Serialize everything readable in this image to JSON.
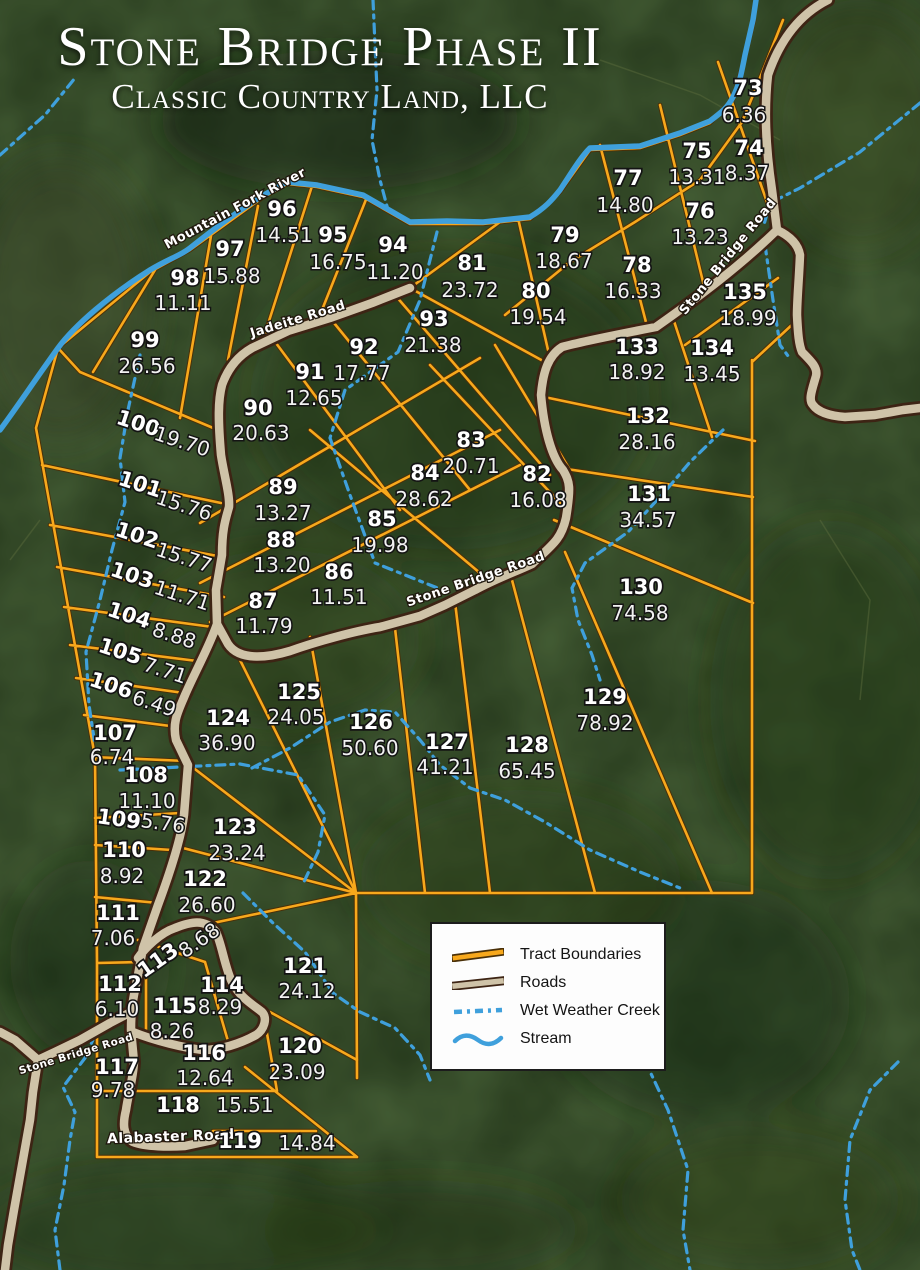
{
  "title": {
    "line1": "Stone Bridge Phase II",
    "line2": "Classic Country Land, LLC"
  },
  "legend": {
    "items": [
      {
        "key": "tract",
        "label": "Tract Boundaries"
      },
      {
        "key": "road",
        "label": "Roads"
      },
      {
        "key": "creek",
        "label": "Wet Weather Creek"
      },
      {
        "key": "stream",
        "label": "Stream"
      }
    ]
  },
  "colors": {
    "tract_boundary": "#F7A81C",
    "tract_boundary_edge": "#4a3008",
    "road_fill": "#CFC3A8",
    "road_edge": "#3d2414",
    "water": "#3FA0DC",
    "label_text": "#ffffff",
    "background_green": "#26391d"
  },
  "road_labels": [
    {
      "name": "Mountain Fork River",
      "x": 237,
      "y": 212,
      "rot": -28,
      "size": 13
    },
    {
      "name": "Jadeite Road",
      "x": 299,
      "y": 323,
      "rot": -17,
      "size": 13
    },
    {
      "name": "Stone Bridge Road",
      "x": 731,
      "y": 259,
      "rot": -51,
      "size": 13
    },
    {
      "name": "Stone Bridge Road",
      "x": 477,
      "y": 583,
      "rot": -19,
      "size": 13
    },
    {
      "name": "Stone Bridge Road",
      "x": 77,
      "y": 1057,
      "rot": -17,
      "size": 10.5
    },
    {
      "name": "Alabaster Road",
      "x": 171,
      "y": 1141,
      "rot": -2,
      "size": 14
    }
  ],
  "tracts": [
    {
      "num": "73",
      "acres": "6.36",
      "x": 748,
      "y": 95,
      "ax": 744,
      "ay": 122,
      "rot": 0
    },
    {
      "num": "74",
      "acres": "8.37",
      "x": 749,
      "y": 155,
      "ax": 747,
      "ay": 180,
      "rot": 0
    },
    {
      "num": "75",
      "acres": "13.31",
      "x": 697,
      "y": 158,
      "ax": 697,
      "ay": 184,
      "rot": 0
    },
    {
      "num": "76",
      "acres": "13.23",
      "x": 700,
      "y": 218,
      "ax": 700,
      "ay": 244,
      "rot": 0
    },
    {
      "num": "77",
      "acres": "14.80",
      "x": 628,
      "y": 185,
      "ax": 625,
      "ay": 212,
      "rot": 0
    },
    {
      "num": "78",
      "acres": "16.33",
      "x": 637,
      "y": 272,
      "ax": 633,
      "ay": 298,
      "rot": 0
    },
    {
      "num": "79",
      "acres": "18.67",
      "x": 565,
      "y": 242,
      "ax": 564,
      "ay": 268,
      "rot": 0
    },
    {
      "num": "80",
      "acres": "19.54",
      "x": 536,
      "y": 298,
      "ax": 538,
      "ay": 324,
      "rot": 0
    },
    {
      "num": "81",
      "acres": "23.72",
      "x": 472,
      "y": 270,
      "ax": 470,
      "ay": 297,
      "rot": 0
    },
    {
      "num": "82",
      "acres": "16.08",
      "x": 537,
      "y": 481,
      "ax": 538,
      "ay": 507,
      "rot": 0
    },
    {
      "num": "83",
      "acres": "20.71",
      "x": 471,
      "y": 447,
      "ax": 471,
      "ay": 473,
      "rot": 0
    },
    {
      "num": "84",
      "acres": "28.62",
      "x": 425,
      "y": 480,
      "ax": 424,
      "ay": 506,
      "rot": 0
    },
    {
      "num": "85",
      "acres": "19.98",
      "x": 382,
      "y": 526,
      "ax": 380,
      "ay": 552,
      "rot": 0
    },
    {
      "num": "86",
      "acres": "11.51",
      "x": 339,
      "y": 579,
      "ax": 339,
      "ay": 604,
      "rot": 0
    },
    {
      "num": "87",
      "acres": "11.79",
      "x": 263,
      "y": 608,
      "ax": 264,
      "ay": 633,
      "rot": 0
    },
    {
      "num": "88",
      "acres": "13.20",
      "x": 281,
      "y": 547,
      "ax": 282,
      "ay": 572,
      "rot": 0
    },
    {
      "num": "89",
      "acres": "13.27",
      "x": 283,
      "y": 494,
      "ax": 283,
      "ay": 520,
      "rot": 0
    },
    {
      "num": "90",
      "acres": "20.63",
      "x": 258,
      "y": 415,
      "ax": 261,
      "ay": 440,
      "rot": 0
    },
    {
      "num": "91",
      "acres": "12.65",
      "x": 310,
      "y": 379,
      "ax": 314,
      "ay": 405,
      "rot": 0
    },
    {
      "num": "92",
      "acres": "17.77",
      "x": 364,
      "y": 354,
      "ax": 362,
      "ay": 380,
      "rot": 0
    },
    {
      "num": "93",
      "acres": "21.38",
      "x": 434,
      "y": 326,
      "ax": 433,
      "ay": 352,
      "rot": 0
    },
    {
      "num": "94",
      "acres": "11.20",
      "x": 393,
      "y": 252,
      "ax": 395,
      "ay": 279,
      "rot": 0
    },
    {
      "num": "95",
      "acres": "16.75",
      "x": 333,
      "y": 242,
      "ax": 338,
      "ay": 269,
      "rot": 0
    },
    {
      "num": "96",
      "acres": "14.51",
      "x": 282,
      "y": 216,
      "ax": 284,
      "ay": 242,
      "rot": 0
    },
    {
      "num": "97",
      "acres": "15.88",
      "x": 230,
      "y": 256,
      "ax": 232,
      "ay": 283,
      "rot": 0
    },
    {
      "num": "98",
      "acres": "11.11",
      "x": 185,
      "y": 285,
      "ax": 183,
      "ay": 310,
      "rot": 0
    },
    {
      "num": "99",
      "acres": "26.56",
      "x": 145,
      "y": 347,
      "ax": 147,
      "ay": 373,
      "rot": 0
    },
    {
      "num": "100",
      "acres": "19.70",
      "x": 136,
      "y": 430,
      "ax": 180,
      "ay": 448,
      "rot": 18
    },
    {
      "num": "101",
      "acres": "15.76",
      "x": 138,
      "y": 491,
      "ax": 182,
      "ay": 512,
      "rot": 18
    },
    {
      "num": "102",
      "acres": "15.77",
      "x": 135,
      "y": 542,
      "ax": 182,
      "ay": 564,
      "rot": 18
    },
    {
      "num": "103",
      "acres": "11.71",
      "x": 130,
      "y": 582,
      "ax": 180,
      "ay": 602,
      "rot": 18
    },
    {
      "num": "104",
      "acres": "8.88",
      "x": 127,
      "y": 622,
      "ax": 172,
      "ay": 642,
      "rot": 18
    },
    {
      "num": "105",
      "acres": "7.71",
      "x": 118,
      "y": 658,
      "ax": 163,
      "ay": 677,
      "rot": 18
    },
    {
      "num": "106",
      "acres": "6.49",
      "x": 109,
      "y": 692,
      "ax": 152,
      "ay": 710,
      "rot": 18
    },
    {
      "num": "107",
      "acres": "6.74",
      "x": 115,
      "y": 740,
      "ax": 112,
      "ay": 764,
      "rot": 0
    },
    {
      "num": "108",
      "acres": "11.10",
      "x": 146,
      "y": 782,
      "ax": 147,
      "ay": 808,
      "rot": 0
    },
    {
      "num": "109",
      "acres": "5.76",
      "x": 118,
      "y": 826,
      "ax": 162,
      "ay": 830,
      "rot": 8
    },
    {
      "num": "110",
      "acres": "8.92",
      "x": 124,
      "y": 857,
      "ax": 122,
      "ay": 883,
      "rot": 0
    },
    {
      "num": "111",
      "acres": "7.06",
      "x": 118,
      "y": 920,
      "ax": 113,
      "ay": 945,
      "rot": 0
    },
    {
      "num": "112",
      "acres": "6.10",
      "x": 120,
      "y": 991,
      "ax": 117,
      "ay": 1016,
      "rot": 0
    },
    {
      "num": "113",
      "acres": "8.68",
      "x": 162,
      "y": 966,
      "ax": 203,
      "ay": 946,
      "rot": -35
    },
    {
      "num": "114",
      "acres": "8.29",
      "x": 222,
      "y": 992,
      "ax": 220,
      "ay": 1014,
      "rot": 0
    },
    {
      "num": "115",
      "acres": "8.26",
      "x": 175,
      "y": 1013,
      "ax": 172,
      "ay": 1038,
      "rot": 0
    },
    {
      "num": "116",
      "acres": "12.64",
      "x": 204,
      "y": 1060,
      "ax": 205,
      "ay": 1085,
      "rot": 0
    },
    {
      "num": "117",
      "acres": "9.78",
      "x": 117,
      "y": 1074,
      "ax": 113,
      "ay": 1097,
      "rot": 0
    },
    {
      "num": "118",
      "acres": "15.51",
      "x": 178,
      "y": 1112,
      "ax": 245,
      "ay": 1112,
      "rot": 0
    },
    {
      "num": "119",
      "acres": "14.84",
      "x": 240,
      "y": 1148,
      "ax": 307,
      "ay": 1150,
      "rot": 0
    },
    {
      "num": "120",
      "acres": "23.09",
      "x": 300,
      "y": 1053,
      "ax": 297,
      "ay": 1079,
      "rot": 0
    },
    {
      "num": "121",
      "acres": "24.12",
      "x": 305,
      "y": 973,
      "ax": 307,
      "ay": 998,
      "rot": 0
    },
    {
      "num": "122",
      "acres": "26.60",
      "x": 205,
      "y": 886,
      "ax": 207,
      "ay": 912,
      "rot": 0
    },
    {
      "num": "123",
      "acres": "23.24",
      "x": 235,
      "y": 834,
      "ax": 237,
      "ay": 860,
      "rot": 0
    },
    {
      "num": "124",
      "acres": "36.90",
      "x": 228,
      "y": 725,
      "ax": 227,
      "ay": 750,
      "rot": 0
    },
    {
      "num": "125",
      "acres": "24.05",
      "x": 299,
      "y": 699,
      "ax": 296,
      "ay": 724,
      "rot": 0
    },
    {
      "num": "126",
      "acres": "50.60",
      "x": 371,
      "y": 729,
      "ax": 370,
      "ay": 755,
      "rot": 0
    },
    {
      "num": "127",
      "acres": "41.21",
      "x": 447,
      "y": 749,
      "ax": 445,
      "ay": 774,
      "rot": 0
    },
    {
      "num": "128",
      "acres": "65.45",
      "x": 527,
      "y": 752,
      "ax": 527,
      "ay": 778,
      "rot": 0
    },
    {
      "num": "129",
      "acres": "78.92",
      "x": 605,
      "y": 704,
      "ax": 605,
      "ay": 730,
      "rot": 0
    },
    {
      "num": "130",
      "acres": "74.58",
      "x": 641,
      "y": 594,
      "ax": 640,
      "ay": 620,
      "rot": 0
    },
    {
      "num": "131",
      "acres": "34.57",
      "x": 649,
      "y": 501,
      "ax": 648,
      "ay": 527,
      "rot": 0
    },
    {
      "num": "132",
      "acres": "28.16",
      "x": 648,
      "y": 423,
      "ax": 647,
      "ay": 449,
      "rot": 0
    },
    {
      "num": "133",
      "acres": "18.92",
      "x": 637,
      "y": 354,
      "ax": 637,
      "ay": 379,
      "rot": 0
    },
    {
      "num": "134",
      "acres": "13.45",
      "x": 712,
      "y": 355,
      "ax": 712,
      "ay": 381,
      "rot": 0
    },
    {
      "num": "135",
      "acres": "18.99",
      "x": 745,
      "y": 299,
      "ax": 748,
      "ay": 325,
      "rot": 0
    }
  ]
}
